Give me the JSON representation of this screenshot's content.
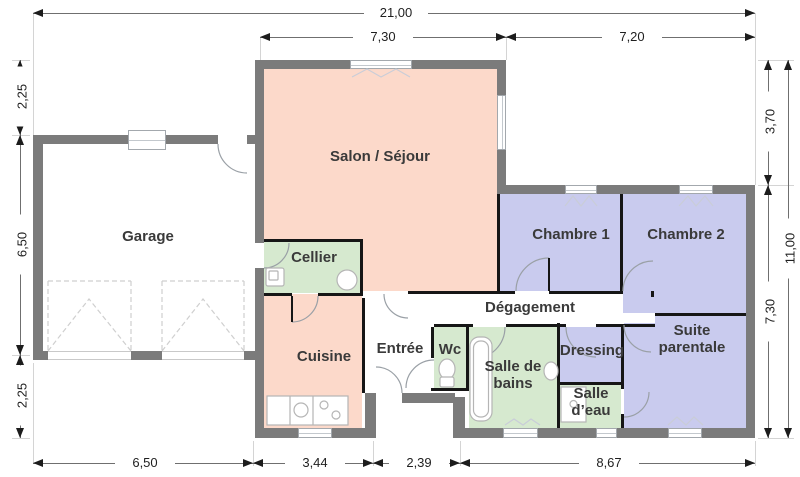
{
  "plan": {
    "rooms": {
      "garage": {
        "label": "Garage"
      },
      "salon": {
        "label": "Salon / Séjour"
      },
      "cellier": {
        "label": "Cellier"
      },
      "cuisine": {
        "label": "Cuisine"
      },
      "entree": {
        "label": "Entrée"
      },
      "wc": {
        "label": "Wc"
      },
      "salle_de_bains": {
        "label": "Salle de bains"
      },
      "dressing": {
        "label": "Dressing"
      },
      "salle_deau": {
        "label": "Salle d’eau"
      },
      "degagement": {
        "label": "Dégagement"
      },
      "chambre1": {
        "label": "Chambre 1"
      },
      "chambre2": {
        "label": "Chambre 2"
      },
      "suite": {
        "label": "Suite parentale"
      }
    },
    "dimensions": {
      "top_total": "21,00",
      "top_salon": "7,30",
      "top_right": "7,20",
      "left_top": "2,25",
      "left_middle": "6,50",
      "left_bottom": "2,25",
      "right_upper": "3,70",
      "right_lower": "7,30",
      "right_total": "11,00",
      "bottom_garage": "6,50",
      "bottom_cuisine": "3,44",
      "bottom_porch": "2,39",
      "bottom_right": "8,67"
    },
    "colors": {
      "wall": "#7b7b7b",
      "partition": "#161616",
      "living_pink": "#fcd9ca",
      "service_green": "#d6e9cf",
      "bedroom_blue": "#c9cbee"
    }
  }
}
